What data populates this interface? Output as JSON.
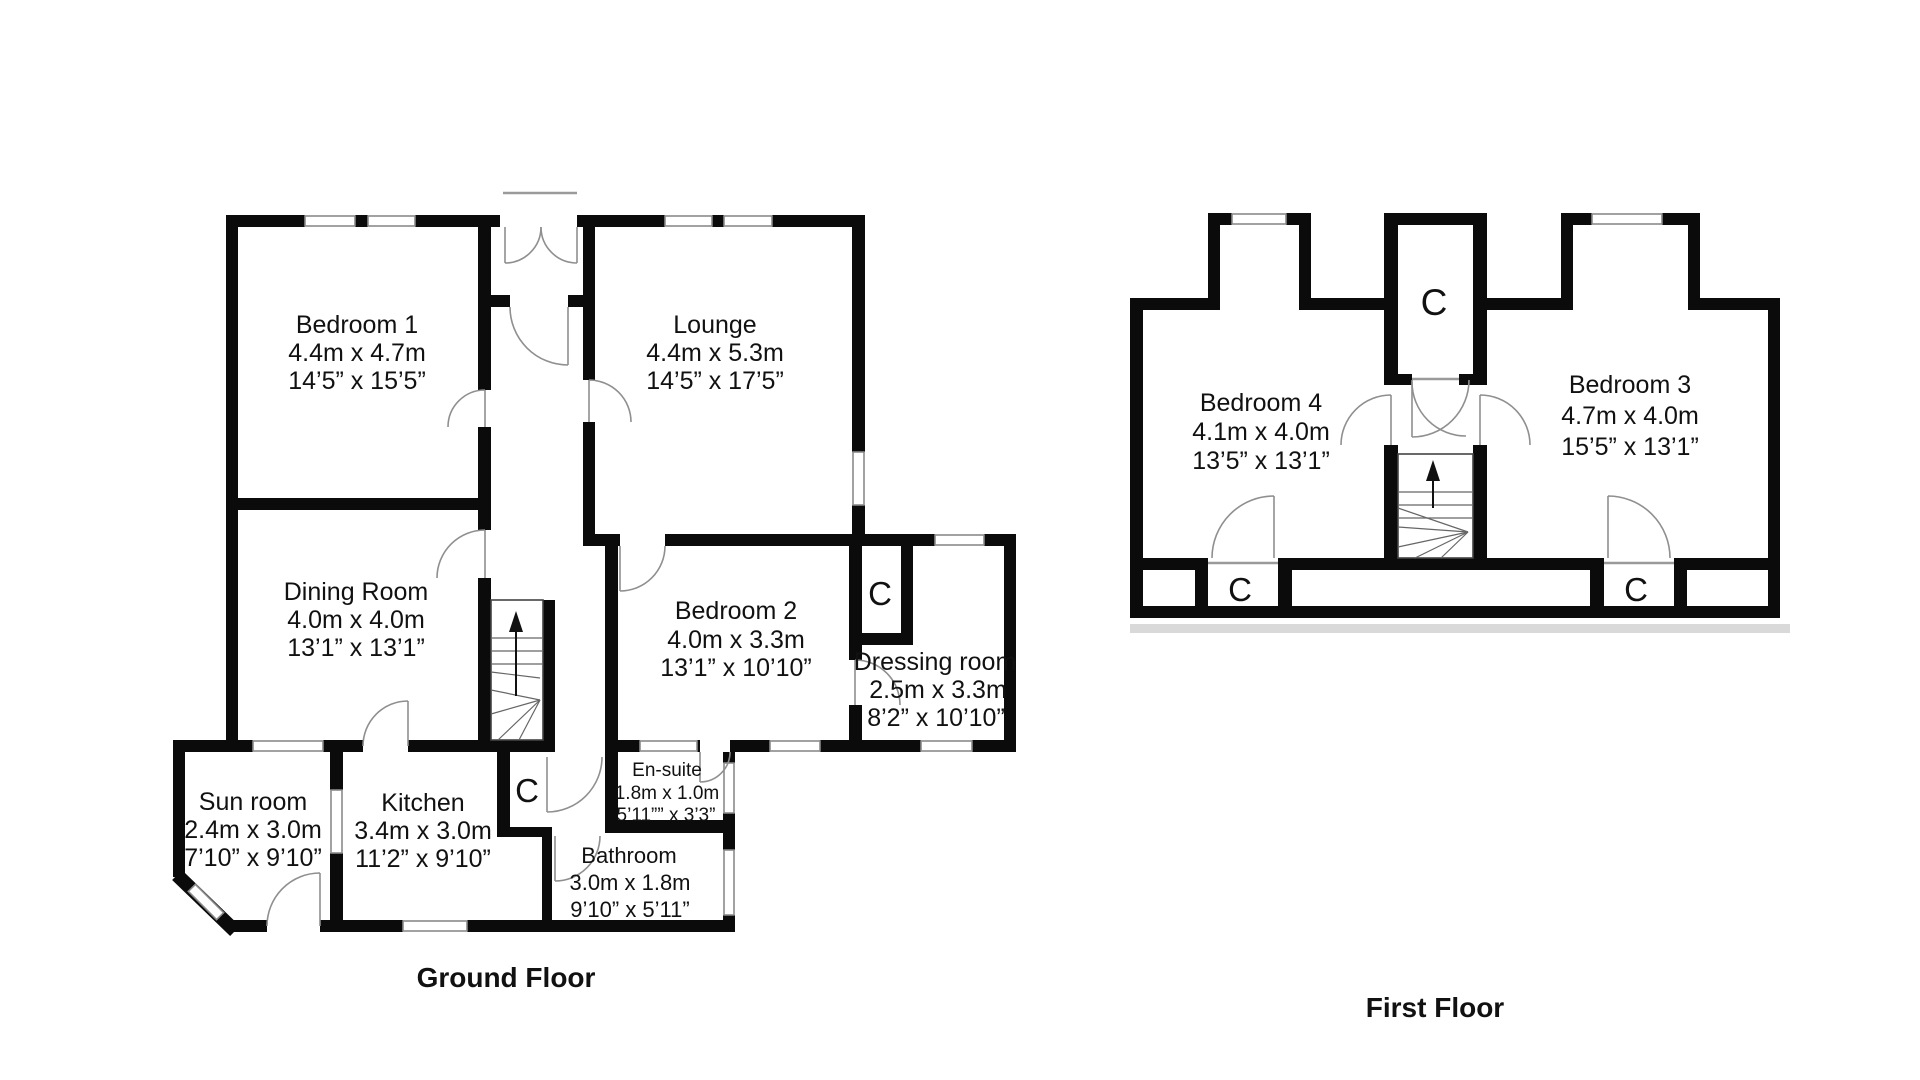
{
  "floors": {
    "ground": {
      "title": "Ground Floor",
      "rooms": {
        "bedroom1": {
          "name": "Bedroom 1",
          "metric": "4.4m x 4.7m",
          "imperial": "14’5” x 15’5”"
        },
        "lounge": {
          "name": "Lounge",
          "metric": "4.4m x 5.3m",
          "imperial": "14’5” x 17’5”"
        },
        "dining": {
          "name": "Dining Room",
          "metric": "4.0m x 4.0m",
          "imperial": "13’1” x 13’1”"
        },
        "bedroom2": {
          "name": "Bedroom 2",
          "metric": "4.0m x 3.3m",
          "imperial": "13’1” x 10’10”"
        },
        "dressing": {
          "name": "Dressing room",
          "metric": "2.5m x 3.3m",
          "imperial": "8’2” x 10’10”"
        },
        "sunroom": {
          "name": "Sun room",
          "metric": "2.4m x 3.0m",
          "imperial": "7’10” x 9’10”"
        },
        "kitchen": {
          "name": "Kitchen",
          "metric": "3.4m x 3.0m",
          "imperial": "11’2” x 9’10”"
        },
        "ensuite": {
          "name": "En-suite",
          "metric": "1.8m x 1.0m",
          "imperial": "5’11”” x 3’3”"
        },
        "bathroom": {
          "name": "Bathroom",
          "metric": "3.0m x 1.8m",
          "imperial": "9’10” x 5’11”"
        }
      },
      "closet_label": "C"
    },
    "first": {
      "title": "First Floor",
      "rooms": {
        "bedroom4": {
          "name": "Bedroom 4",
          "metric": "4.1m x 4.0m",
          "imperial": "13’5” x 13’1”"
        },
        "bedroom3": {
          "name": "Bedroom 3",
          "metric": "4.7m x 4.0m",
          "imperial": "15’5” x 13’1”"
        }
      },
      "closet_label": "C"
    }
  }
}
